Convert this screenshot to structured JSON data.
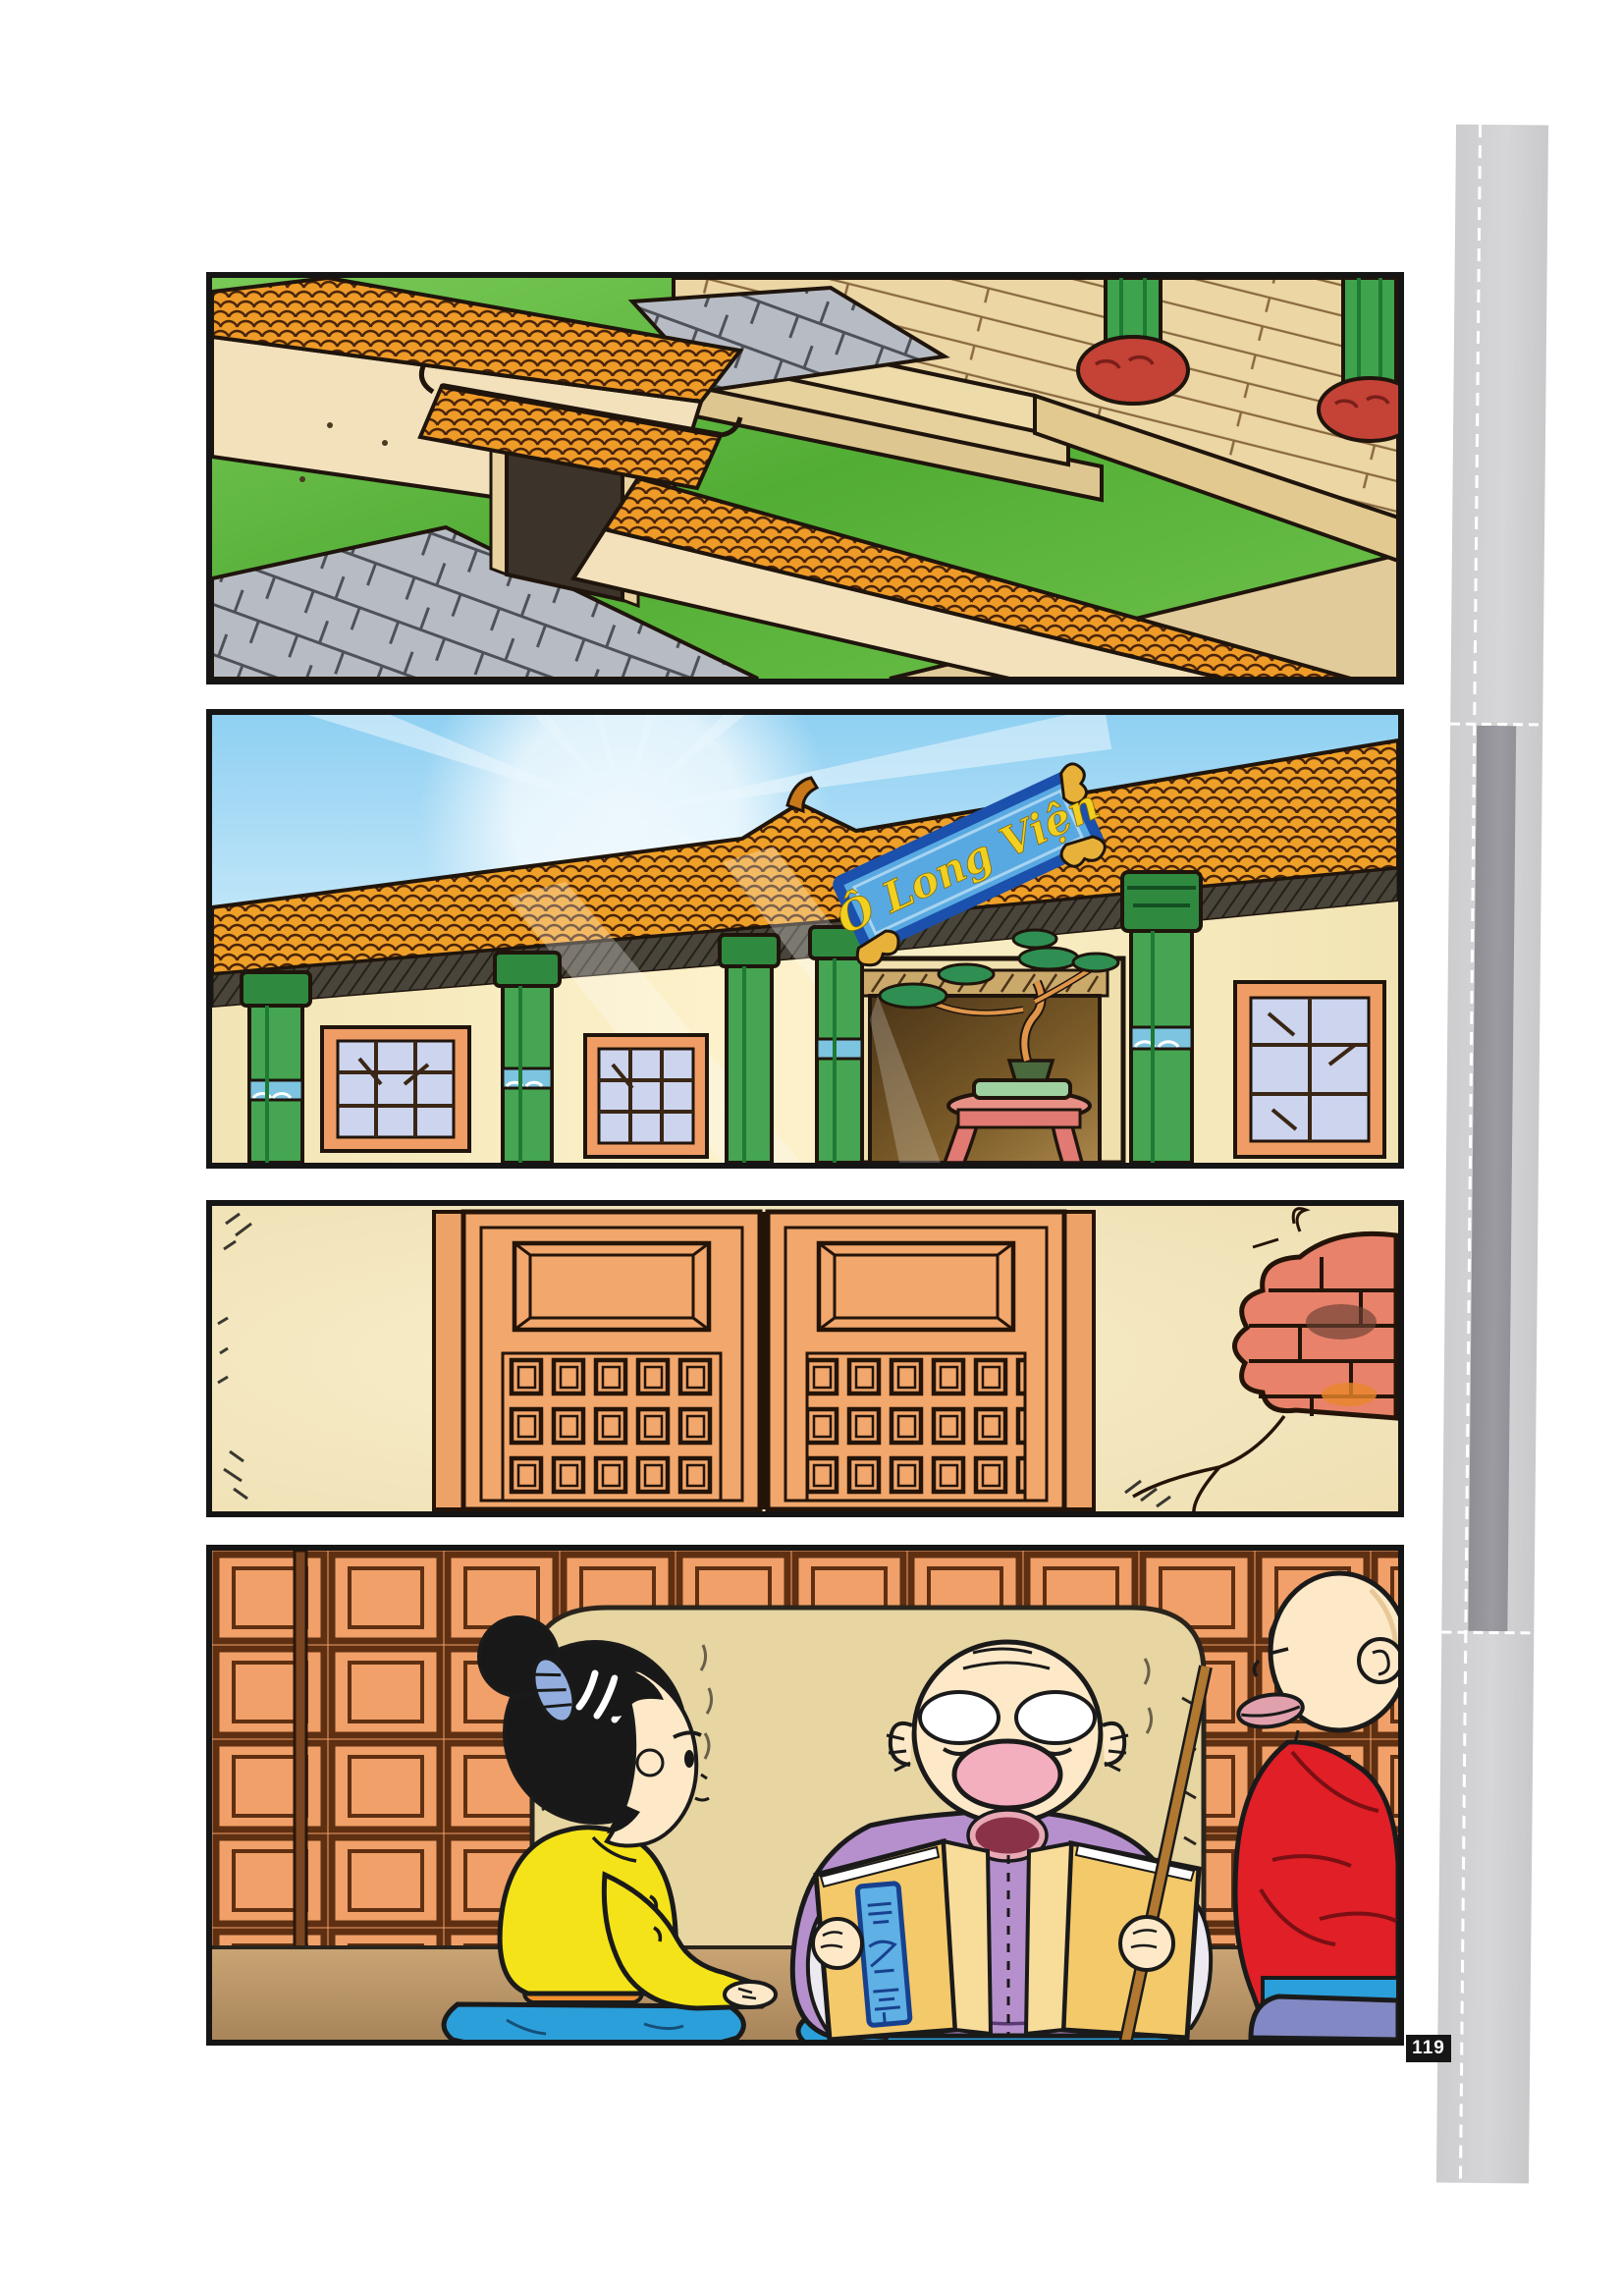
{
  "page": {
    "number": "119",
    "background": "#ffffff"
  },
  "sign": {
    "text": "Ô Long Viện",
    "board_color": "#58a9e2",
    "border_color": "#1b50ac",
    "text_color": "#f2d020"
  },
  "book": {
    "label": "百喻經"
  },
  "panels": [
    {
      "alt": "Bird's-eye view of a temple courtyard: cream walls topped with orange roof tiles, a small gate, grey flagstone paths, green lawn, wooden platform with steps and green columns on red carved bases"
    },
    {
      "alt": "Sunburst over the temple facade: orange tiled roof, green columns, lattice windows, blue name board reading O Long Vien above a dark doorway with a bonsai tree on a pink table"
    },
    {
      "alt": "Closed orange double wooden doors with bevelled top panels and coffered squares; plaster wall cracked open showing red bricks at right"
    },
    {
      "alt": "Inside the hall: a girl in yellow and a young monk in red sit facing an old monk in purple who reads aloud from a sutra book while holding a wooden stick"
    }
  ],
  "page_edge": {
    "light": "#d3d3d5",
    "dark": "#97969c"
  },
  "palette": {
    "panel_border": "#151515",
    "roof_tile_orange": "#ef9b28",
    "grass_green": "#52ad35",
    "wall_cream": "#f3e1bc",
    "column_green": "#3fa34e",
    "column_base_red": "#c54236",
    "sky_blue": "#9fd6f2",
    "door_orange": "#f2a76c",
    "brick_red": "#e8826a",
    "lattice_orange": "#f0a068",
    "floor_tan": "#c9a474",
    "girl_jacket_yellow": "#f4e318",
    "monk_robe_purple": "#b690cc",
    "young_monk_robe_red": "#e01f26",
    "cushion_blue": "#2b9fd9",
    "book_cover": "#f4c96a",
    "badge_bg": "#161616",
    "badge_text": "#ffffff"
  }
}
